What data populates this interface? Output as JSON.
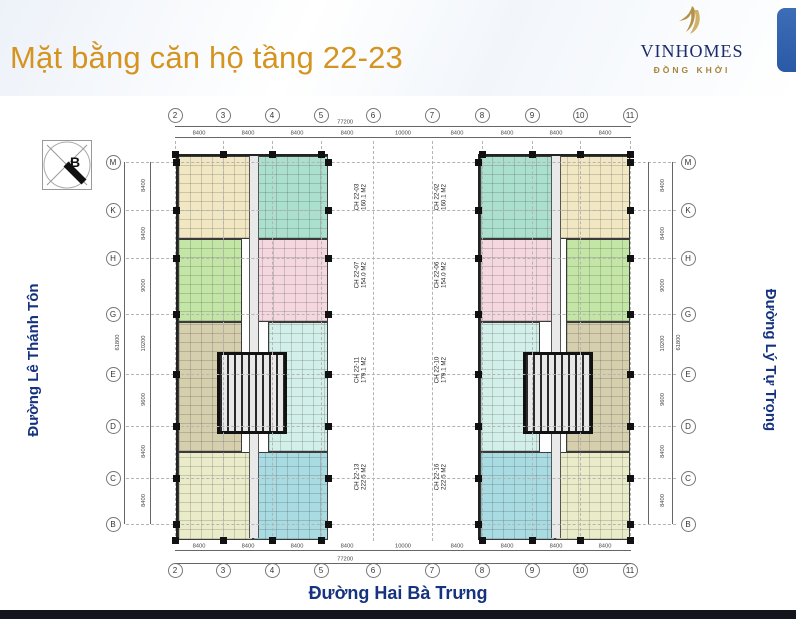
{
  "header": {
    "title": "Mặt bằng căn hộ tầng 22-23",
    "logo": {
      "brand": "VINHOMES",
      "subtitle": "ĐỒNG KHỞI"
    }
  },
  "plan": {
    "compass_label": "B",
    "grid": {
      "columns": [
        "2",
        "3",
        "4",
        "5",
        "6",
        "7",
        "8",
        "9",
        "10",
        "11"
      ],
      "rows": [
        "M",
        "K",
        "H",
        "G",
        "E",
        "D",
        "C",
        "B"
      ],
      "h_dims": [
        "8400",
        "8400",
        "8400",
        "8400",
        "10000",
        "8400",
        "8400",
        "8400",
        "8400"
      ],
      "v_dims": [
        "8400",
        "8400",
        "9000",
        "10200",
        "9600",
        "8400",
        "8400"
      ],
      "overall_width": "77200",
      "overall_height": "61800"
    },
    "units": {
      "left_tower": [
        {
          "id": "CH 22-03",
          "area": "160.1 M2"
        },
        {
          "id": "CH 22-07",
          "area": "154.0 M2"
        },
        {
          "id": "CH 22-11",
          "area": "179.1 M2"
        },
        {
          "id": "CH 22-13",
          "area": "222.5 M2"
        }
      ],
      "right_tower": [
        {
          "id": "CH 22-02",
          "area": "160.1 M2"
        },
        {
          "id": "CH 22-06",
          "area": "154.0 M2"
        },
        {
          "id": "CH 22-10",
          "area": "179.1 M2"
        },
        {
          "id": "CH 22-16",
          "area": "222.5 M2"
        }
      ]
    },
    "streets": {
      "left": "Đường Lê Thánh Tôn",
      "right": "Đường Lý Tự Trọng",
      "bottom": "Đường Hai Bà Trưng"
    },
    "colors": {
      "cream": "#f1e7c3",
      "mint": "#abe0cf",
      "green": "#c3e6a6",
      "pink": "#f5d7e0",
      "tan": "#d6cfae",
      "pale_cyan": "#d3efe9",
      "pale_yellow": "#eaebc8",
      "cyan": "#a8dce2",
      "title_orange": "#d4941f",
      "street_navy": "#16337f",
      "logo_navy": "#1b2c6e",
      "logo_gold": "#a8843a",
      "tab_blue": "#2f5fa9"
    }
  }
}
